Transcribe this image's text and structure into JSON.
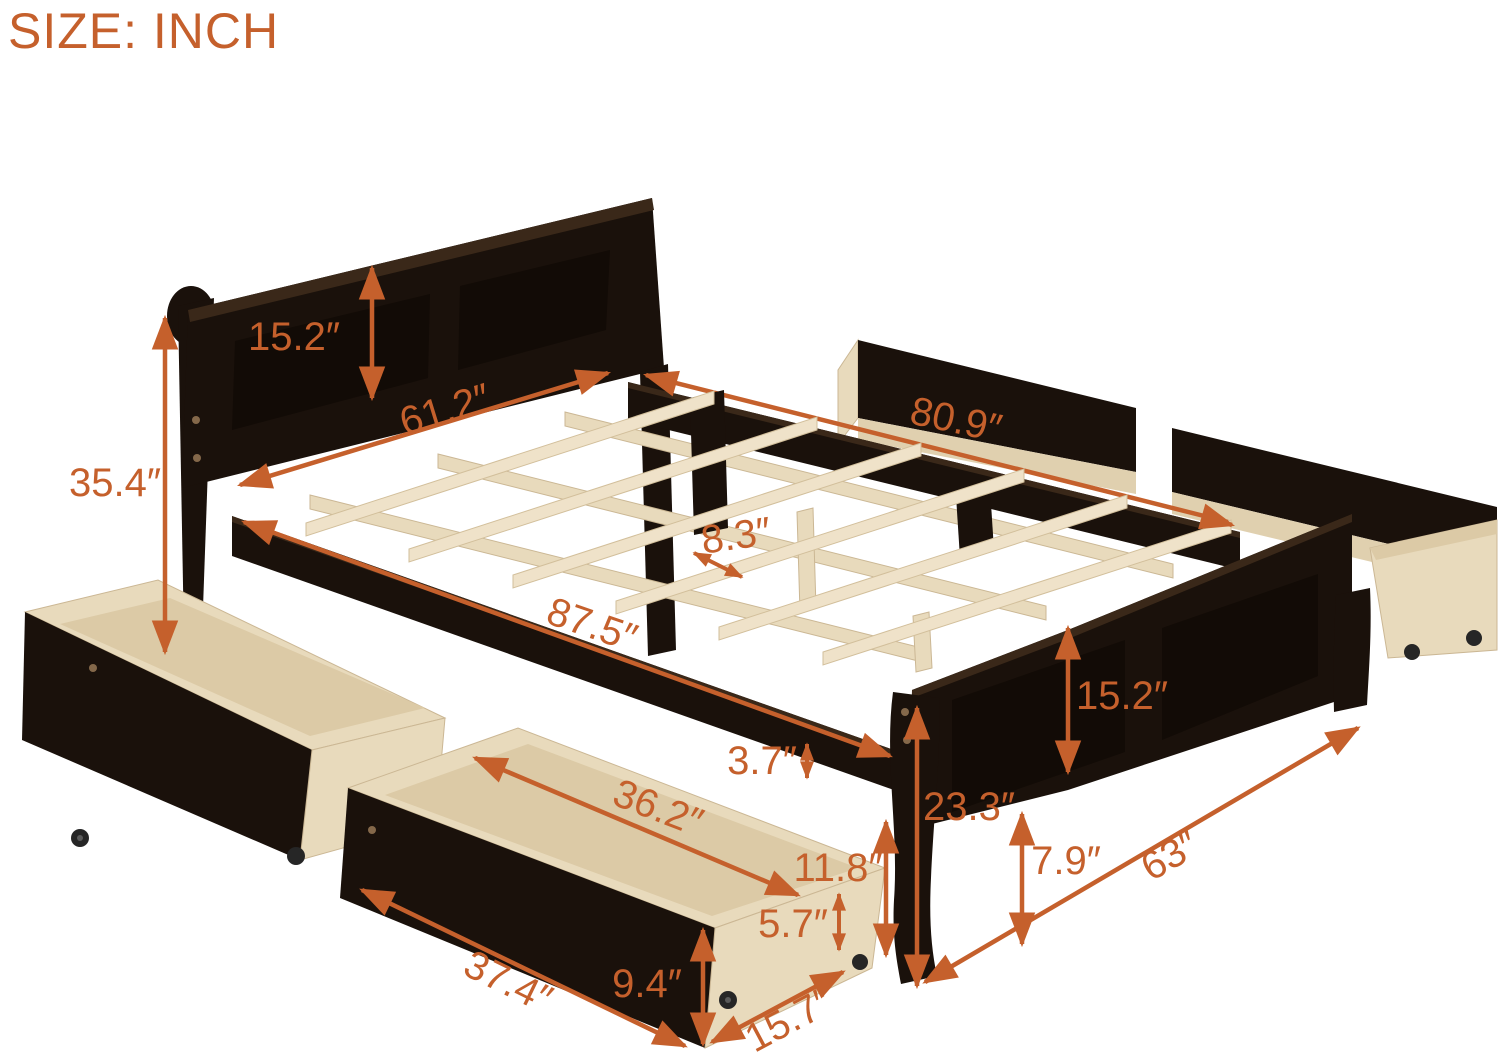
{
  "title": "SIZE: INCH",
  "unit": "INCH",
  "colors": {
    "accent": "#c5602c",
    "frame_wood": "#1a110b",
    "slat_wood": "#efe2c9",
    "drawer_wood": "#e8dabc",
    "background": "#ffffff"
  },
  "dimensions": {
    "headboard_panel_height": "15.2″",
    "headboard_width": "61.2″",
    "headboard_height": "35.4″",
    "frame_inner_length": "80.9″",
    "slat_spacing": "8.3″",
    "frame_outer_length": "87.5″",
    "footboard_panel_height": "15.2″",
    "side_rail_thickness": "3.7″",
    "footboard_height": "23.3″",
    "drawer_height_with_casters": "11.8″",
    "drawer_side_height": "5.7″",
    "under_bed_clearance": "7.9″",
    "footboard_width": "63″",
    "drawer_inner_length": "36.2″",
    "drawer_front_length": "37.4″",
    "drawer_front_height": "9.4″",
    "drawer_depth": "15.7″"
  }
}
